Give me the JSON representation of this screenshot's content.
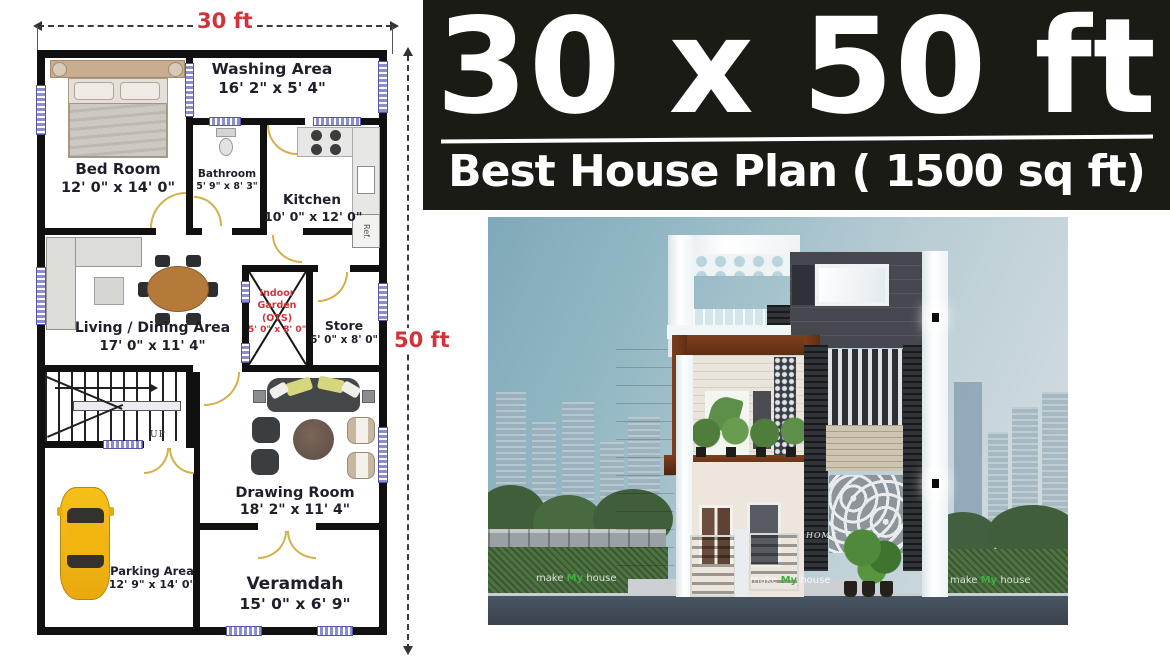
{
  "banner": {
    "title": "30 x 50 ft",
    "subtitle": "Best House Plan ( 1500 sq ft)"
  },
  "dimensions": {
    "width_label": "30 ft",
    "height_label": "50 ft"
  },
  "plan": {
    "rooms": [
      {
        "name": "Bed Room",
        "dims": "12' 0\" x 14' 0\""
      },
      {
        "name": "Washing Area",
        "dims": "16' 2\" x 5' 4\""
      },
      {
        "name": "Bathroom",
        "dims": "5' 9\" x 8' 3\""
      },
      {
        "name": "Kitchen",
        "dims": "10' 0\" x 12' 0\""
      },
      {
        "name": "Living / Dining Area",
        "dims": "17' 0\" x 11' 4\""
      },
      {
        "name": "Indoor Garden (OTS)",
        "dims": "5' 0\" x 8' 0\""
      },
      {
        "name": "Store",
        "dims": "6' 0\" x 8' 0\""
      },
      {
        "name": "Drawing Room",
        "dims": "18' 2\" x 11' 4\""
      },
      {
        "name": "Parking Area",
        "dims": "12' 9\" x 14' 0\""
      },
      {
        "name": "Veramdah",
        "dims": "15' 0\" x 6' 9\""
      }
    ],
    "stairs_label": "UP",
    "fridge_label": "Ref."
  },
  "render": {
    "home_text": "HOME",
    "watermark": {
      "pre": "make",
      "brand": "My",
      "post": "house"
    }
  },
  "colors": {
    "banner_bg": "#1b1b15",
    "accent_red": "#d2333a",
    "wall": "#101010",
    "window_mark": "#8c8cd0",
    "door_arc": "#d4b04a",
    "car_yellow": "#f3b616",
    "brown_frame": "#6e3517"
  }
}
